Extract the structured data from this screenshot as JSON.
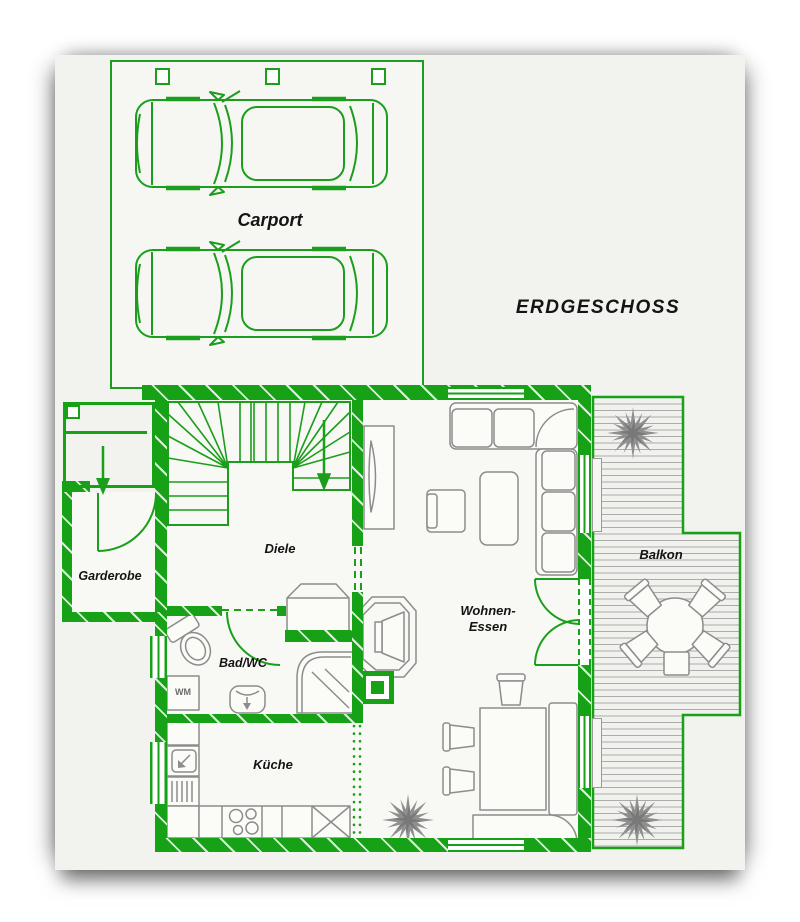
{
  "floorplan": {
    "title": "ERDGESCHOSS",
    "areas": {
      "carport": "Carport",
      "garderobe": "Garderobe",
      "diele": "Diele",
      "bad_wc": "Bad/WC",
      "kueche": "Küche",
      "wohnen_essen_line1": "Wohnen-",
      "wohnen_essen_line2": "Essen",
      "balkon": "Balkon"
    },
    "appliances": {
      "washing_machine": "WM"
    }
  },
  "colors": {
    "wall-green": "#16a116",
    "line-green": "#1b9e1b",
    "furniture-gray": "#8c8c8c",
    "label-black": "#141414",
    "sheet-bg": "#f2f2ef"
  },
  "icons": [
    "car-icon",
    "plant-icon",
    "entry-arrow-icon",
    "stair-arrow-icon"
  ]
}
